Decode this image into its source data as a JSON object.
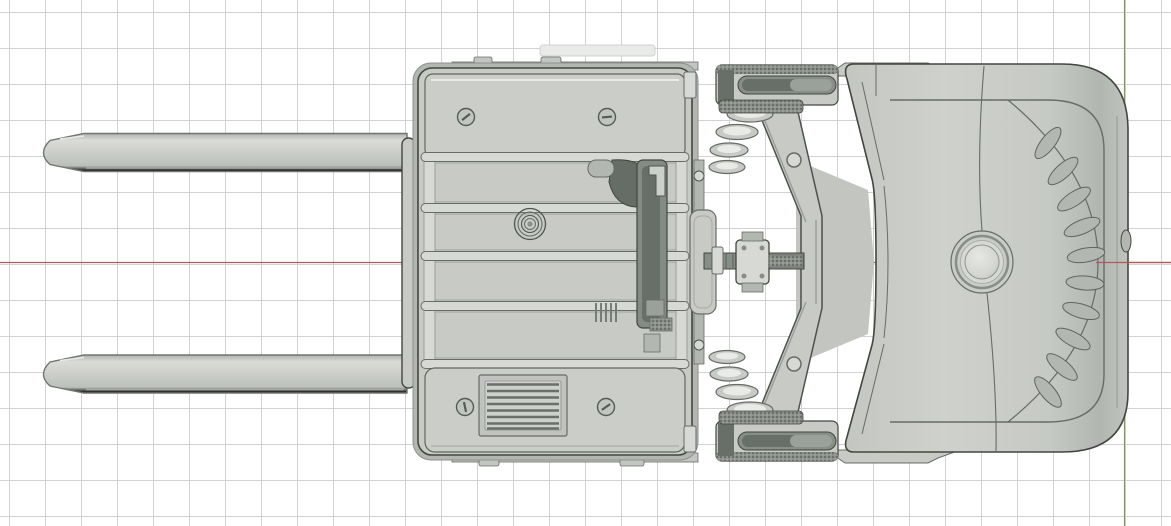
{
  "viewport": {
    "kind": "3d-cad-viewport",
    "view": "top",
    "width_px": 1171,
    "height_px": 526
  },
  "grid": {
    "spacing_px": 36,
    "offset_x_px": 9,
    "offset_y_px": 12
  },
  "axes": {
    "x_axis": {
      "screen_y_px": 262.5,
      "color_key": "axis_x"
    },
    "y_axis": {
      "screen_x_px": 1124.5,
      "color_key": "axis_y"
    }
  },
  "colors": {
    "background": "#ffffff",
    "grid_line": "#d2d2d2",
    "axis_x": "#b2595b",
    "axis_y": "#7d9b58",
    "outline": "#42473e",
    "edge": "#676c66",
    "fill": "#c7cac5",
    "fill_light": "#d7d9d5",
    "fill_lighter": "#e9ebe8",
    "fill_dark": "#b3b7b2",
    "recess": "#878d87",
    "recess_dark": "#686e68",
    "knurl_mid": "#8b908a",
    "knurl_dark": "#545953"
  },
  "model": {
    "name": "electric-pallet-truck-top-view",
    "parts": [
      {
        "id": "fork-upper",
        "label": "upper fork"
      },
      {
        "id": "fork-lower",
        "label": "lower fork"
      },
      {
        "id": "fork-hanger-bar",
        "label": "fork hanger bar"
      },
      {
        "id": "fork-carriage",
        "label": "fork carriage / battery box"
      },
      {
        "id": "access-panel-top",
        "label": "top access panel"
      },
      {
        "id": "access-panel-bottom",
        "label": "bottom access panel"
      },
      {
        "id": "vent-grille",
        "label": "vent grille"
      },
      {
        "id": "damper-coil",
        "label": "coil detail"
      },
      {
        "id": "hydraulic-channel",
        "label": "hydraulic channel"
      },
      {
        "id": "push-rod",
        "label": "push rod assembly"
      },
      {
        "id": "steering-chevron",
        "label": "steering linkage arms"
      },
      {
        "id": "roller-stack-upper",
        "label": "upper roller stack"
      },
      {
        "id": "roller-stack-lower",
        "label": "lower roller stack"
      },
      {
        "id": "wheel-bogie-upper",
        "label": "upper wheel bogie"
      },
      {
        "id": "wheel-bogie-lower",
        "label": "lower wheel bogie"
      },
      {
        "id": "drive-unit-cover",
        "label": "drive unit cover"
      },
      {
        "id": "horn-button",
        "label": "horn button"
      },
      {
        "id": "cooling-vents",
        "label": "cooling vent slots"
      },
      {
        "id": "side-latch",
        "label": "side latch nub"
      }
    ]
  }
}
